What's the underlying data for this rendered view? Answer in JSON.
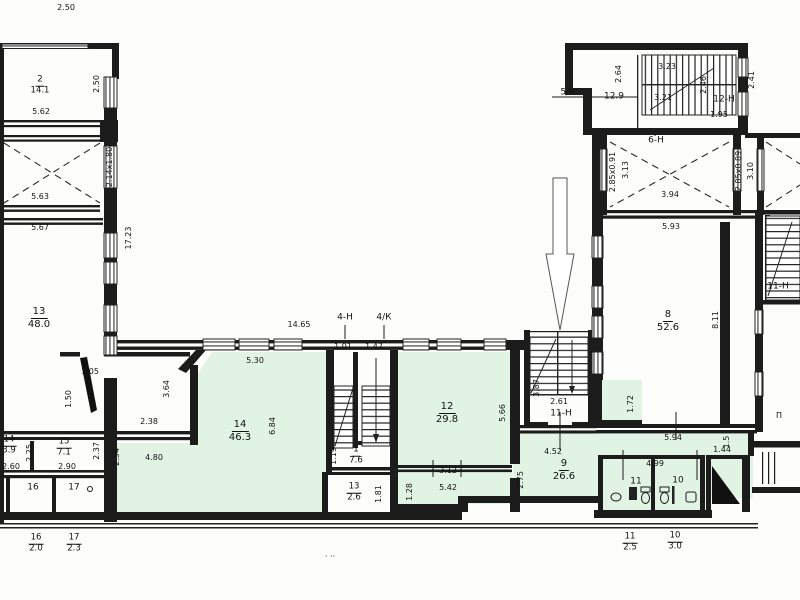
{
  "rooms": {
    "r2": {
      "num": "2",
      "area": "14.1"
    },
    "r13": {
      "num": "13",
      "area": "48.0"
    },
    "r14s": {
      "num": "14",
      "area": "3.9"
    },
    "r15": {
      "num": "15",
      "area": "7.1"
    },
    "r16": {
      "num": "16"
    },
    "r17": {
      "num": "17"
    },
    "r14": {
      "num": "14",
      "area": "46.3"
    },
    "r1": {
      "num": "1",
      "area": "7.6"
    },
    "r13s": {
      "num": "13",
      "area": "2.6"
    },
    "r12": {
      "num": "12",
      "area": "29.8"
    },
    "r9": {
      "num": "9",
      "area": "26.6"
    },
    "r11": {
      "num": "11"
    },
    "r10": {
      "num": "10"
    },
    "r8": {
      "num": "8",
      "area": "52.6"
    }
  },
  "halls": {
    "h5k": "5/К",
    "h4n": "4-Н",
    "h4k": "4/К",
    "h6n": "6-Н",
    "h11n": "11-Н",
    "h12n": "12-Н",
    "h11nr": "11-Н"
  },
  "footer": {
    "f16": {
      "num": "16",
      "val": "2.0"
    },
    "f17": {
      "num": "17",
      "val": "2.3"
    },
    "f11": {
      "num": "11",
      "val": "2.5"
    },
    "f10": {
      "num": "10",
      "val": "3.0"
    }
  },
  "dims": {
    "d250a": "2.50",
    "d562": "5.62",
    "d250b": "2.50",
    "d214": "2.14x1.80",
    "d563": "5.63",
    "d567": "5.67",
    "d1723": "17.23",
    "d105": "1.05",
    "d150": "1.50",
    "d260": "2.60",
    "d225": "2.25",
    "d290": "2.90",
    "d237": "2.37",
    "d254": "2.54",
    "d238": "2.38",
    "d480": "4.80",
    "d1465": "14.65",
    "d101": "1.01",
    "d147": "1.47",
    "d530": "5.30",
    "d364": "3.64",
    "d684": "6.84",
    "d119": "1.19",
    "d181": "1.81",
    "d128": "1.28",
    "d312": "3.12",
    "d542": "5.42",
    "d275": "2.75",
    "d566": "5.66",
    "d387": "3.87",
    "d261": "2.61",
    "d452": "4.52",
    "d172": "1.72",
    "d594": "5.94",
    "d15": "1.5",
    "d144": "1.44",
    "d499": "4.99",
    "d129": "12.9",
    "d264": "2.64",
    "d323": "3.23",
    "d321": "3.21",
    "d246": "2.46",
    "d195": "1.95",
    "d241": "2.41",
    "d28591": "2.85x0.91",
    "d313": "3.13",
    "d394": "3.94",
    "d28589": "2.85x0.89",
    "d310": "3.10",
    "d593": "5.93",
    "d811": "8.11"
  },
  "misc": {
    "pi": "П",
    "dots": "· ··"
  },
  "colors": {
    "room_tint": "#e1f3e3",
    "line": "#1c1c1c"
  }
}
